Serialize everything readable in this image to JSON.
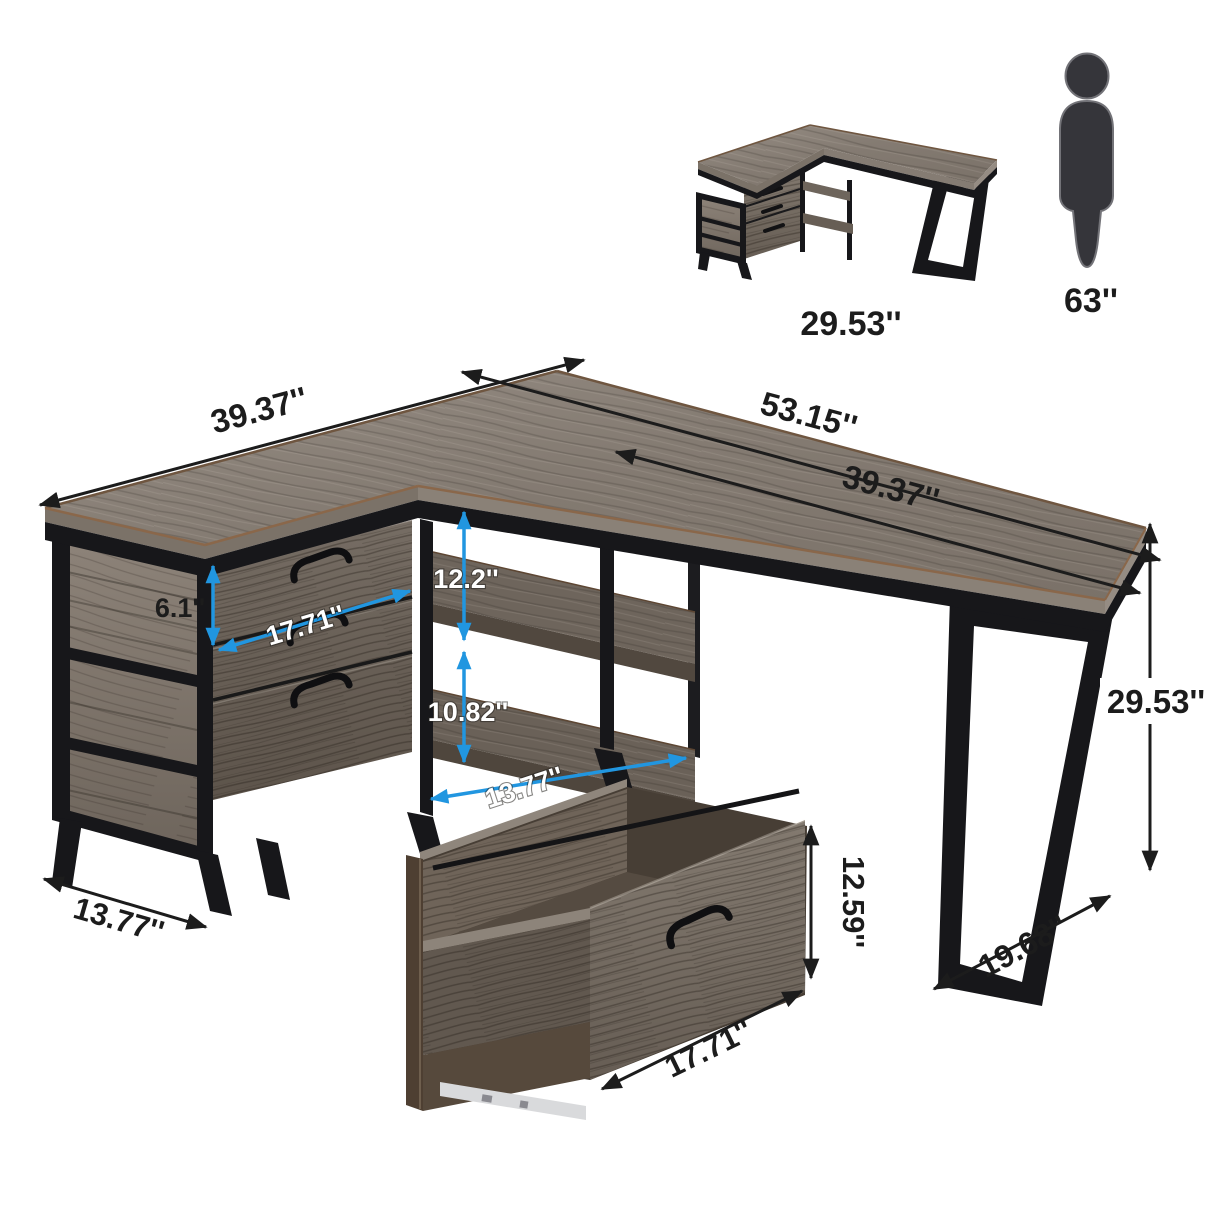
{
  "title": "L-Shaped Desk with Drawers - Dimension Diagram",
  "reference": {
    "desk_height": "29.53''",
    "person_height": "63''"
  },
  "dimensions": {
    "left_arm_length": "39.37''",
    "total_length": "53.15''",
    "right_arm_length": "39.37''",
    "desk_height": "29.53''",
    "leg_depth": "19.68''",
    "cabinet_depth": "13.77''",
    "shelf_depth": "13.77''",
    "top_drawer_height": "6.1''",
    "drawer_width": "17.71''",
    "upper_shelf_gap": "12.2''",
    "lower_shelf_gap": "10.82''",
    "file_drawer_height": "12.59''",
    "file_drawer_width": "17.71''"
  },
  "colors": {
    "dimension_blue": "#2196e0",
    "dimension_black": "#1c1c1c",
    "wood_top": "#877e75",
    "wood_dark": "#5f564d",
    "metal_black": "#17171a"
  }
}
